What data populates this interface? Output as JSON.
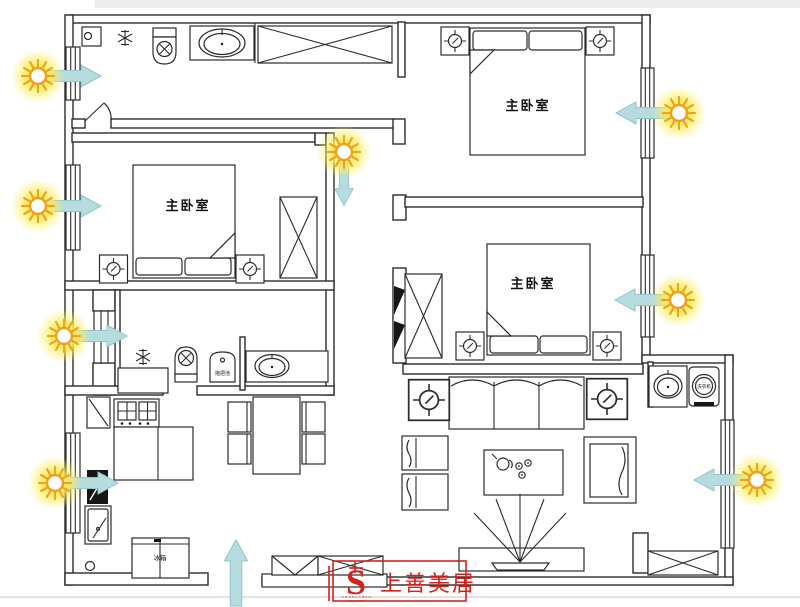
{
  "rooms": {
    "bedroom_left": {
      "label": "主卧室"
    },
    "bedroom_top_right": {
      "label": "主卧室"
    },
    "bedroom_mid_right": {
      "label": "主卧室"
    }
  },
  "fixtures": {
    "mop_sink": "拖把池",
    "fridge": "冰箱",
    "washing_machine": "洗衣机"
  },
  "logo": {
    "brand": "上善美居",
    "monogram": "S",
    "sub_line1": "SHANGSHAN",
    "sub_line2": "MEIJU"
  },
  "colors": {
    "wall_line": "#2b2b2b",
    "sun_glow": "#ffee58",
    "sun_ray": "#f3a21a",
    "sun_core": "#ffffff",
    "arrow_fill": "#b6dce0",
    "arrow_edge": "#8fc7cd",
    "logo_red": "#d2221f",
    "background": "#ffffff"
  },
  "icons": {
    "sun-icon": "☀",
    "light-arrow-icon": "➜",
    "entrance-arrow-icon": "⬆",
    "snowflake-icon": "✳",
    "toilet-icon": "⊗",
    "sink-icon": "⬭",
    "lamp-crosshair-icon": "⊕",
    "wardrobe-cross-icon": "✕"
  }
}
